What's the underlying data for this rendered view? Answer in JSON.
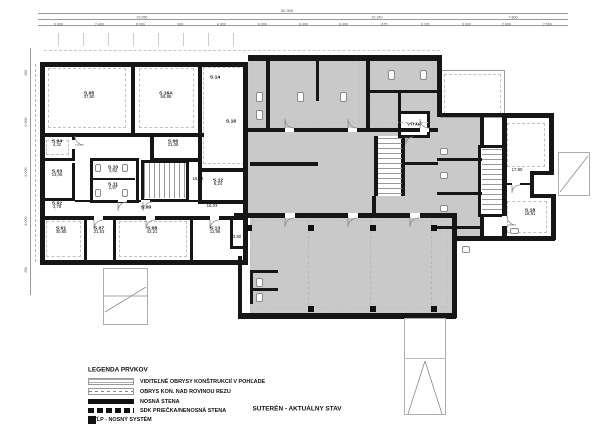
{
  "title": "SUTERÉN - AKTUÁLNY STAV",
  "elevator_label": "VÝŤAH",
  "legend": {
    "heading": "LEGENDA PRVKOV",
    "items": [
      {
        "symbol": "visible-outline-symbol",
        "label": "VIDITEĽNÉ OBRYSY KONŠTRUKCIÍ V POHĽADE"
      },
      {
        "symbol": "above-section-outline-symbol",
        "label": "OBRYS KON. NAD ROVINOU REZU"
      },
      {
        "symbol": "load-bearing-wall-symbol",
        "label": "NOSNÁ STENA"
      },
      {
        "symbol": "partition-wall-symbol",
        "label": "SDK PRIEČKA/NENOSNÁ STENA"
      },
      {
        "symbol": "column-symbol",
        "label": "STĹP - NOSNÝ SYSTÉM"
      }
    ]
  },
  "rooms": [
    {
      "id": "S.05",
      "area": "37,60",
      "x": 89,
      "y": 95
    },
    {
      "id": "S.16A",
      "area": "56,88",
      "x": 166,
      "y": 95
    },
    {
      "id": "S.14",
      "area": "",
      "x": 215,
      "y": 77
    },
    {
      "id": "S.16",
      "area": "",
      "x": 231,
      "y": 121
    },
    {
      "id": "S.04",
      "area": "4,32",
      "x": 57,
      "y": 143
    },
    {
      "id": "S.06",
      "area": "21,06",
      "x": 173,
      "y": 143
    },
    {
      "id": "S.03",
      "area": "13,06",
      "x": 57,
      "y": 173
    },
    {
      "id": "S.10",
      "area": "3,92",
      "x": 113,
      "y": 169
    },
    {
      "id": "S.11",
      "area": "1,97",
      "x": 113,
      "y": 186
    },
    {
      "id": "",
      "area": "16,88",
      "x": 198,
      "y": 179
    },
    {
      "id": "S.12",
      "area": "6,24",
      "x": 218,
      "y": 182
    },
    {
      "id": "S.02",
      "area": "3,78",
      "x": 57,
      "y": 205
    },
    {
      "id": "S.09",
      "area": "",
      "x": 146,
      "y": 207
    },
    {
      "id": "",
      "area": "16,03",
      "x": 212,
      "y": 206
    },
    {
      "id": "S.01",
      "area": "30,85",
      "x": 61,
      "y": 230
    },
    {
      "id": "S.07",
      "area": "21,53",
      "x": 99,
      "y": 230
    },
    {
      "id": "S.08",
      "area": "43,21",
      "x": 152,
      "y": 230
    },
    {
      "id": "S.13",
      "area": "11,96",
      "x": 215,
      "y": 230
    },
    {
      "id": "",
      "area": "3,80",
      "x": 237,
      "y": 237
    },
    {
      "id": "",
      "area": "17,80",
      "x": 517,
      "y": 170
    },
    {
      "id": "S.18",
      "area": "18,81",
      "x": 530,
      "y": 212
    }
  ],
  "dimensions": {
    "top_row1": "50 300",
    "top_row2": [
      "29 050",
      "22 240",
      "7 800"
    ],
    "top_row3": [
      "6 000",
      "2 400",
      "6 000",
      "900",
      "4 900",
      "6 000",
      "6 000",
      "6 000",
      "675",
      "3 181",
      "3 092",
      "2 800",
      "2 500"
    ],
    "left_col": [
      "450",
      "6 000",
      "6 000",
      "6 000",
      "450"
    ]
  }
}
